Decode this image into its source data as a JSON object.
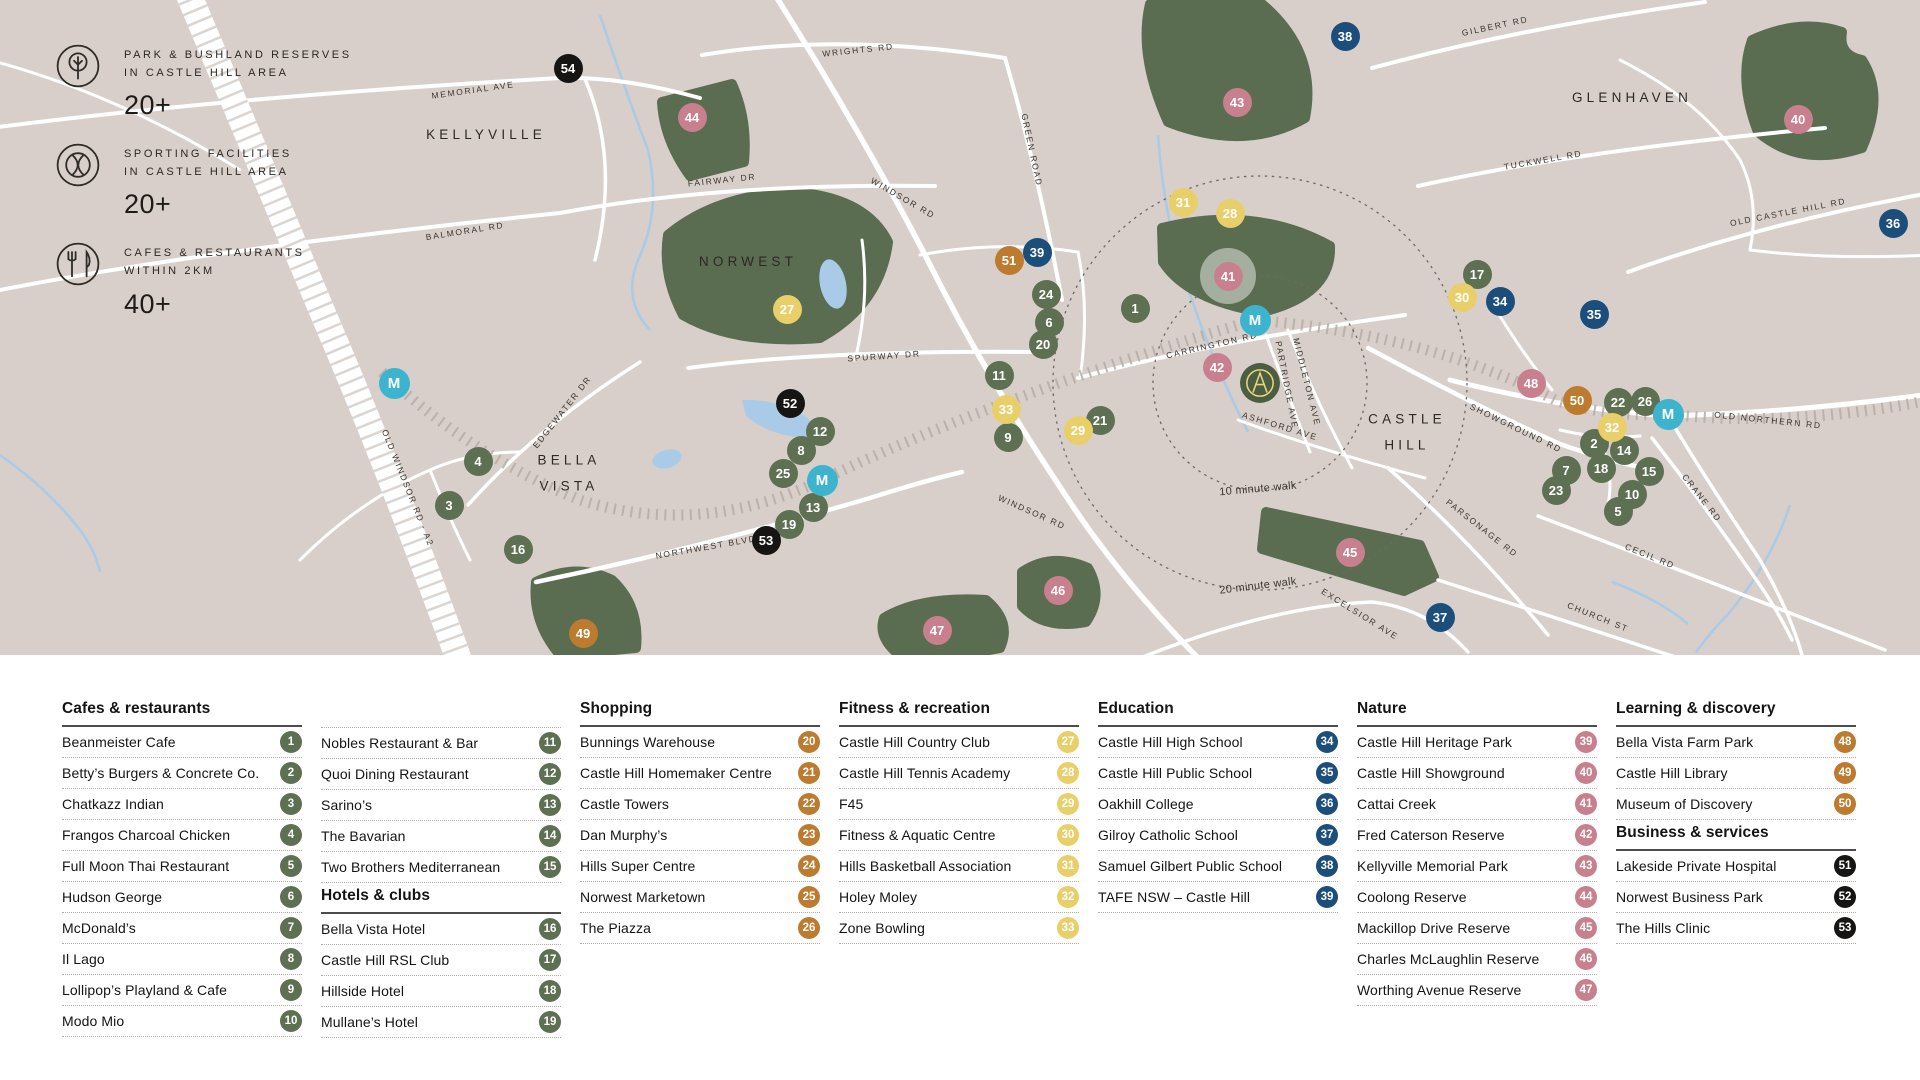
{
  "stats": [
    {
      "icon": "tree-icon",
      "line1": "PARK & BUSHLAND RESERVES",
      "line2": "IN CASTLE HILL AREA",
      "value": "20+"
    },
    {
      "icon": "tennis-icon",
      "line1": "SPORTING FACILITIES",
      "line2": "IN CASTLE HILL AREA",
      "value": "20+"
    },
    {
      "icon": "cutlery-icon",
      "line1": "CAFES & RESTAURANTS",
      "line2": "WITHIN 2KM",
      "value": "40+"
    }
  ],
  "map": {
    "colors": {
      "green": "#5d7052",
      "orange": "#bd7b30",
      "yellow": "#e8cf6a",
      "blue": "#1c4e7c",
      "pink": "#c8808e",
      "black": "#161514",
      "teal": "#3cb4ce",
      "park": "#5b6d50",
      "background": "#d8cfca",
      "water": "#a9cbe7",
      "road": "#ffffff"
    },
    "area_labels": [
      {
        "text": "KELLYVILLE",
        "x": 486,
        "y": 135
      },
      {
        "text": "NORWEST",
        "x": 748,
        "y": 262
      },
      {
        "text": "BELLA",
        "line2": "VISTA",
        "x": 569,
        "y": 474
      },
      {
        "text": "CASTLE",
        "line2": "HILL",
        "x": 1407,
        "y": 433
      },
      {
        "text": "GLENHAVEN",
        "x": 1632,
        "y": 98
      }
    ],
    "road_labels": [
      {
        "text": "MEMORIAL AVE",
        "x": 473,
        "y": 90,
        "r": -8
      },
      {
        "text": "BALMORAL RD",
        "x": 465,
        "y": 231,
        "r": -9
      },
      {
        "text": "FAIRWAY DR",
        "x": 722,
        "y": 180,
        "r": -6
      },
      {
        "text": "WRIGHTS RD",
        "x": 858,
        "y": 50,
        "r": -6
      },
      {
        "text": "GREEN ROAD",
        "x": 1032,
        "y": 150,
        "r": 78
      },
      {
        "text": "WINDSOR RD",
        "x": 903,
        "y": 198,
        "r": 30
      },
      {
        "text": "WINDSOR RD",
        "x": 1032,
        "y": 512,
        "r": 24
      },
      {
        "text": "GILBERT RD",
        "x": 1495,
        "y": 26,
        "r": -12
      },
      {
        "text": "TUCKWELL RD",
        "x": 1543,
        "y": 160,
        "r": -10
      },
      {
        "text": "OLD CASTLE HILL RD",
        "x": 1788,
        "y": 212,
        "r": -11
      },
      {
        "text": "OLD NORTHERN RD",
        "x": 1768,
        "y": 420,
        "r": 6
      },
      {
        "text": "SHOWGROUND RD",
        "x": 1516,
        "y": 428,
        "r": 26
      },
      {
        "text": "SPURWAY DR",
        "x": 884,
        "y": 356,
        "r": -4
      },
      {
        "text": "EDGEWATER DR",
        "x": 562,
        "y": 412,
        "r": -52
      },
      {
        "text": "OLD WINDSOR RD - A2",
        "x": 408,
        "y": 488,
        "r": 68
      },
      {
        "text": "NORTHWEST BLVD",
        "x": 706,
        "y": 547,
        "r": -10
      },
      {
        "text": "CARRINGTON RD",
        "x": 1212,
        "y": 345,
        "r": -13
      },
      {
        "text": "MIDDLETON AVE",
        "x": 1307,
        "y": 382,
        "r": 76
      },
      {
        "text": "PARTRIDGE AVE",
        "x": 1287,
        "y": 385,
        "r": 79
      },
      {
        "text": "ASHFORD AVE",
        "x": 1280,
        "y": 426,
        "r": 17
      },
      {
        "text": "CRANE RD",
        "x": 1702,
        "y": 498,
        "r": 52
      },
      {
        "text": "CECIL RD",
        "x": 1650,
        "y": 556,
        "r": 22
      },
      {
        "text": "CHURCH ST",
        "x": 1598,
        "y": 617,
        "r": 22
      },
      {
        "text": "PARSONAGE RD",
        "x": 1482,
        "y": 528,
        "r": 38
      },
      {
        "text": "EXCELSIOR AVE",
        "x": 1360,
        "y": 614,
        "r": 32
      },
      {
        "text": "10 minute walk",
        "x": 1258,
        "y": 489,
        "r": -5,
        "walk": true
      },
      {
        "text": "20 minute walk",
        "x": 1258,
        "y": 586,
        "r": -7,
        "walk": true
      }
    ],
    "markers": [
      {
        "n": "1",
        "c": "green",
        "x": 1135,
        "y": 308
      },
      {
        "n": "2",
        "c": "green",
        "x": 1594,
        "y": 443
      },
      {
        "n": "3",
        "c": "green",
        "x": 449,
        "y": 505
      },
      {
        "n": "4",
        "c": "green",
        "x": 478,
        "y": 461
      },
      {
        "n": "5",
        "c": "green",
        "x": 1618,
        "y": 511
      },
      {
        "n": "6",
        "c": "green",
        "x": 1049,
        "y": 322
      },
      {
        "n": "7",
        "c": "green",
        "x": 1566,
        "y": 470
      },
      {
        "n": "8",
        "c": "green",
        "x": 801,
        "y": 450
      },
      {
        "n": "9",
        "c": "green",
        "x": 1008,
        "y": 437
      },
      {
        "n": "10",
        "c": "green",
        "x": 1632,
        "y": 494
      },
      {
        "n": "11",
        "c": "green",
        "x": 999,
        "y": 375
      },
      {
        "n": "12",
        "c": "green",
        "x": 820,
        "y": 431
      },
      {
        "n": "13",
        "c": "green",
        "x": 813,
        "y": 507
      },
      {
        "n": "14",
        "c": "green",
        "x": 1624,
        "y": 450
      },
      {
        "n": "15",
        "c": "green",
        "x": 1649,
        "y": 471
      },
      {
        "n": "16",
        "c": "green",
        "x": 518,
        "y": 549
      },
      {
        "n": "17",
        "c": "green",
        "x": 1477,
        "y": 274
      },
      {
        "n": "18",
        "c": "green",
        "x": 1601,
        "y": 468
      },
      {
        "n": "19",
        "c": "green",
        "x": 789,
        "y": 524
      },
      {
        "n": "20",
        "c": "green",
        "x": 1043,
        "y": 344
      },
      {
        "n": "21",
        "c": "green",
        "x": 1100,
        "y": 420
      },
      {
        "n": "22",
        "c": "green",
        "x": 1618,
        "y": 402
      },
      {
        "n": "23",
        "c": "green",
        "x": 1556,
        "y": 490
      },
      {
        "n": "24",
        "c": "green",
        "x": 1046,
        "y": 294
      },
      {
        "n": "25",
        "c": "green",
        "x": 783,
        "y": 473
      },
      {
        "n": "26",
        "c": "green",
        "x": 1645,
        "y": 401
      },
      {
        "n": "27",
        "c": "yellow",
        "x": 787,
        "y": 309
      },
      {
        "n": "28",
        "c": "yellow",
        "x": 1230,
        "y": 213
      },
      {
        "n": "29",
        "c": "yellow",
        "x": 1078,
        "y": 430
      },
      {
        "n": "30",
        "c": "yellow",
        "x": 1462,
        "y": 297
      },
      {
        "n": "31",
        "c": "yellow",
        "x": 1183,
        "y": 202
      },
      {
        "n": "32",
        "c": "yellow",
        "x": 1612,
        "y": 427
      },
      {
        "n": "33",
        "c": "yellow",
        "x": 1006,
        "y": 409
      },
      {
        "n": "34",
        "c": "blue",
        "x": 1500,
        "y": 301
      },
      {
        "n": "35",
        "c": "blue",
        "x": 1594,
        "y": 314
      },
      {
        "n": "36",
        "c": "blue",
        "x": 1893,
        "y": 223
      },
      {
        "n": "37",
        "c": "blue",
        "x": 1440,
        "y": 617
      },
      {
        "n": "38",
        "c": "blue",
        "x": 1345,
        "y": 36
      },
      {
        "n": "39",
        "c": "blue",
        "x": 1037,
        "y": 252
      },
      {
        "n": "40",
        "c": "pink",
        "x": 1798,
        "y": 119
      },
      {
        "n": "41",
        "c": "pink",
        "x": 1228,
        "y": 276,
        "halo": true
      },
      {
        "n": "42",
        "c": "pink",
        "x": 1217,
        "y": 367
      },
      {
        "n": "43",
        "c": "pink",
        "x": 1237,
        "y": 102
      },
      {
        "n": "44",
        "c": "pink",
        "x": 692,
        "y": 117
      },
      {
        "n": "45",
        "c": "pink",
        "x": 1350,
        "y": 552
      },
      {
        "n": "46",
        "c": "pink",
        "x": 1058,
        "y": 590
      },
      {
        "n": "47",
        "c": "pink",
        "x": 937,
        "y": 630
      },
      {
        "n": "48",
        "c": "pink",
        "x": 1531,
        "y": 383
      },
      {
        "n": "49",
        "c": "orange",
        "x": 583,
        "y": 633
      },
      {
        "n": "50",
        "c": "orange",
        "x": 1577,
        "y": 400
      },
      {
        "n": "51",
        "c": "orange",
        "x": 1009,
        "y": 260
      },
      {
        "n": "52",
        "c": "black",
        "x": 790,
        "y": 403
      },
      {
        "n": "53",
        "c": "black",
        "x": 766,
        "y": 540
      },
      {
        "n": "54",
        "c": "black",
        "x": 568,
        "y": 68
      },
      {
        "n": "M",
        "c": "teal",
        "x": 394,
        "y": 383
      },
      {
        "n": "M",
        "c": "teal",
        "x": 822,
        "y": 480
      },
      {
        "n": "M",
        "c": "teal",
        "x": 1255,
        "y": 320
      },
      {
        "n": "M",
        "c": "teal",
        "x": 1668,
        "y": 414
      }
    ]
  },
  "legend": {
    "columns": [
      {
        "sections": [
          {
            "title": "Cafes & restaurants",
            "items": [
              {
                "label": "Beanmeister Cafe",
                "num": "1",
                "color": "green"
              },
              {
                "label": "Betty’s Burgers & Concrete Co.",
                "num": "2",
                "color": "green"
              },
              {
                "label": "Chatkazz Indian",
                "num": "3",
                "color": "green"
              },
              {
                "label": "Frangos Charcoal Chicken",
                "num": "4",
                "color": "green"
              },
              {
                "label": "Full Moon Thai Restaurant",
                "num": "5",
                "color": "green"
              },
              {
                "label": "Hudson George",
                "num": "6",
                "color": "green"
              },
              {
                "label": "McDonald’s",
                "num": "7",
                "color": "green"
              },
              {
                "label": "Il Lago",
                "num": "8",
                "color": "green"
              },
              {
                "label": "Lollipop’s Playland & Cafe",
                "num": "9",
                "color": "green"
              },
              {
                "label": "Modo Mio",
                "num": "10",
                "color": "green"
              }
            ]
          }
        ]
      },
      {
        "sections": [
          {
            "title": null,
            "items": [
              {
                "label": "Nobles Restaurant & Bar",
                "num": "11",
                "color": "green"
              },
              {
                "label": "Quoi Dining Restaurant",
                "num": "12",
                "color": "green"
              },
              {
                "label": "Sarino’s",
                "num": "13",
                "color": "green"
              },
              {
                "label": "The Bavarian",
                "num": "14",
                "color": "green"
              },
              {
                "label": "Two Brothers Mediterranean",
                "num": "15",
                "color": "green"
              }
            ]
          },
          {
            "title": "Hotels & clubs",
            "items": [
              {
                "label": "Bella Vista Hotel",
                "num": "16",
                "color": "green"
              },
              {
                "label": "Castle Hill RSL Club",
                "num": "17",
                "color": "green"
              },
              {
                "label": "Hillside Hotel",
                "num": "18",
                "color": "green"
              },
              {
                "label": "Mullane’s Hotel",
                "num": "19",
                "color": "green"
              }
            ]
          }
        ]
      },
      {
        "sections": [
          {
            "title": "Shopping",
            "items": [
              {
                "label": "Bunnings Warehouse",
                "num": "20",
                "color": "orange"
              },
              {
                "label": "Castle Hill Homemaker Centre",
                "num": "21",
                "color": "orange"
              },
              {
                "label": "Castle Towers",
                "num": "22",
                "color": "orange"
              },
              {
                "label": "Dan Murphy’s",
                "num": "23",
                "color": "orange"
              },
              {
                "label": "Hills Super Centre",
                "num": "24",
                "color": "orange"
              },
              {
                "label": "Norwest Marketown",
                "num": "25",
                "color": "orange"
              },
              {
                "label": "The Piazza",
                "num": "26",
                "color": "orange"
              }
            ]
          }
        ]
      },
      {
        "sections": [
          {
            "title": "Fitness & recreation",
            "items": [
              {
                "label": "Castle Hill Country Club",
                "num": "27",
                "color": "yellow"
              },
              {
                "label": "Castle Hill Tennis Academy",
                "num": "28",
                "color": "yellow"
              },
              {
                "label": "F45",
                "num": "29",
                "color": "yellow"
              },
              {
                "label": "Fitness & Aquatic Centre",
                "num": "30",
                "color": "yellow"
              },
              {
                "label": "Hills Basketball Association",
                "num": "31",
                "color": "yellow"
              },
              {
                "label": "Holey Moley",
                "num": "32",
                "color": "yellow"
              },
              {
                "label": "Zone Bowling",
                "num": "33",
                "color": "yellow"
              }
            ]
          }
        ]
      },
      {
        "sections": [
          {
            "title": "Education",
            "items": [
              {
                "label": "Castle Hill High School",
                "num": "34",
                "color": "blue"
              },
              {
                "label": "Castle Hill Public School",
                "num": "35",
                "color": "blue"
              },
              {
                "label": "Oakhill College",
                "num": "36",
                "color": "blue"
              },
              {
                "label": "Gilroy Catholic School",
                "num": "37",
                "color": "blue"
              },
              {
                "label": "Samuel Gilbert Public School",
                "num": "38",
                "color": "blue"
              },
              {
                "label": "TAFE NSW – Castle Hill",
                "num": "39",
                "color": "blue"
              }
            ]
          }
        ]
      },
      {
        "sections": [
          {
            "title": "Nature",
            "items": [
              {
                "label": "Castle Hill Heritage Park",
                "num": "39",
                "color": "pink"
              },
              {
                "label": "Castle Hill Showground",
                "num": "40",
                "color": "pink"
              },
              {
                "label": "Cattai Creek",
                "num": "41",
                "color": "pink"
              },
              {
                "label": "Fred Caterson Reserve",
                "num": "42",
                "color": "pink"
              },
              {
                "label": "Kellyville Memorial Park",
                "num": "43",
                "color": "pink"
              },
              {
                "label": "Coolong Reserve",
                "num": "44",
                "color": "pink"
              },
              {
                "label": "Mackillop Drive Reserve",
                "num": "45",
                "color": "pink"
              },
              {
                "label": "Charles McLaughlin Reserve",
                "num": "46",
                "color": "pink"
              },
              {
                "label": "Worthing Avenue Reserve",
                "num": "47",
                "color": "pink"
              }
            ]
          }
        ]
      },
      {
        "sections": [
          {
            "title": "Learning & discovery",
            "items": [
              {
                "label": "Bella Vista Farm Park",
                "num": "48",
                "color": "orange"
              },
              {
                "label": "Castle Hill Library",
                "num": "49",
                "color": "orange"
              },
              {
                "label": "Museum of Discovery",
                "num": "50",
                "color": "orange"
              }
            ]
          },
          {
            "title": "Business & services",
            "items": [
              {
                "label": "Lakeside Private Hospital",
                "num": "51",
                "color": "black"
              },
              {
                "label": "Norwest Business Park",
                "num": "52",
                "color": "black"
              },
              {
                "label": "The Hills Clinic",
                "num": "53",
                "color": "black"
              }
            ]
          }
        ]
      }
    ]
  }
}
